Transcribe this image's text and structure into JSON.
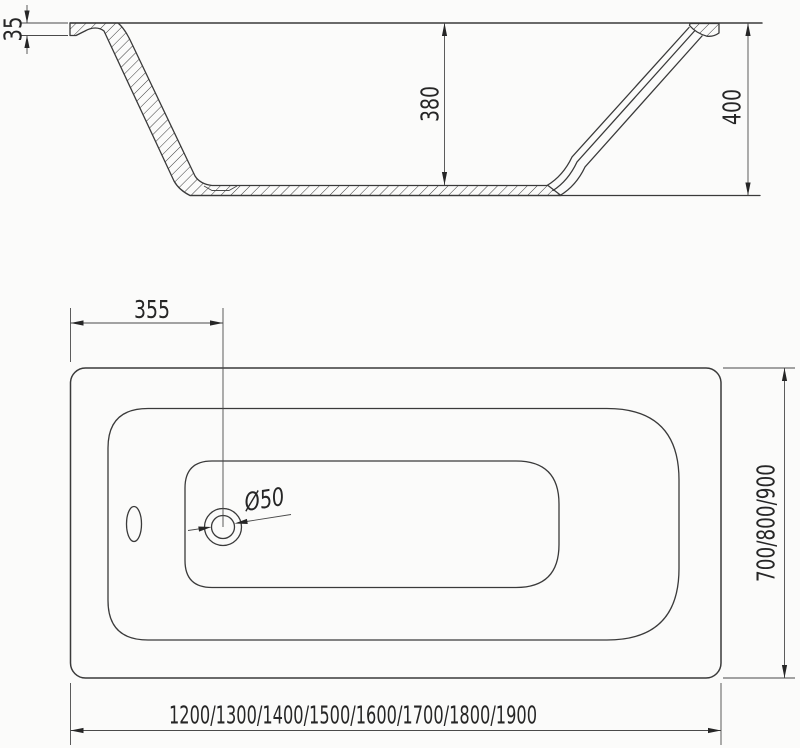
{
  "drawing": {
    "side_view": {
      "labels": {
        "rim_height": "35",
        "depth": "380",
        "height": "400"
      }
    },
    "top_view": {
      "labels": {
        "drain_offset": "355",
        "drain_diameter": "Ø50",
        "width_options": "700/800/900",
        "length_options": "1200/1300/1400/1500/1600/1700/1800/1900"
      }
    },
    "colors": {
      "line": "#3a3a3a",
      "dimension": "#4a4a4a",
      "text": "#262626",
      "background": "#fbfbfa"
    }
  }
}
